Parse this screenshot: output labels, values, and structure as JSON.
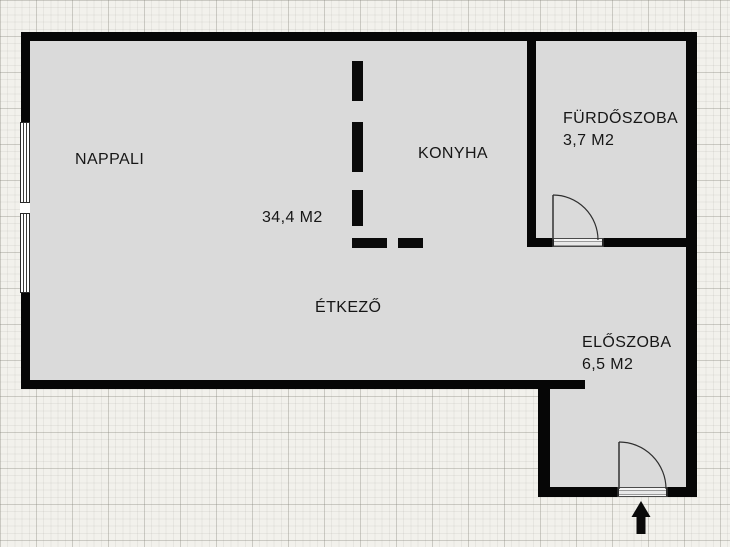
{
  "plan_type": "apartment-floor-plan",
  "language": "hu",
  "rooms": {
    "nappali": {
      "label": "NAPPALI",
      "area": "34,4 M2"
    },
    "konyha": {
      "label": "KONYHA"
    },
    "furdoszoba": {
      "label": "FÜRDŐSZOBA",
      "area": "3,7 M2"
    },
    "etkezo": {
      "label": "ÉTKEZŐ"
    },
    "eloszoba": {
      "label": "ELŐSZOBA",
      "area": "6,5 M2"
    }
  },
  "symbols": {
    "entrance_arrow": "up-arrow",
    "doors": [
      "furdoszoba-door",
      "entrance-door"
    ],
    "window": "double-window-left-wall",
    "partition": "dashed-kitchen-divider"
  },
  "colors": {
    "wall": "#060606",
    "floor": "#dadada",
    "background": "#f2f1ec",
    "text": "#161616"
  }
}
